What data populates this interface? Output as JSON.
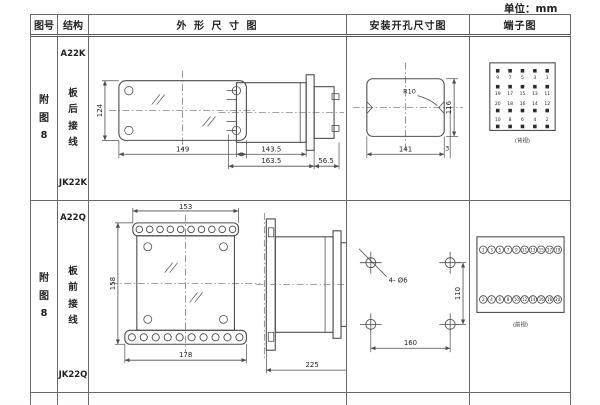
{
  "unit_label": "单位：mm",
  "headers": {
    "fig_no": "图号",
    "structure": "结构",
    "outline": "外 形 尺 寸 图",
    "mounting": "安装开孔尺寸图",
    "terminal": "端子图"
  },
  "rows": [
    {
      "fig_no": "附\n图\n8",
      "model_top": "A22K",
      "wiring": "板\n后\n接\n线",
      "model_bottom": "JK22K",
      "outline": {
        "h": "124",
        "w": "149",
        "d1": "143.5",
        "d2": "163.5",
        "d3": "56.5"
      },
      "mount": {
        "r": "R10",
        "w": "141",
        "h": "116",
        "off": "3"
      },
      "terminal": {
        "caption": "(背视)",
        "grid": [
          [
            "9",
            "7",
            "5",
            "3",
            "1"
          ],
          [
            "19",
            "17",
            "15",
            "13",
            "11"
          ],
          [
            "20",
            "18",
            "16",
            "14",
            "12"
          ],
          [
            "10",
            "8",
            "6",
            "4",
            "2"
          ]
        ]
      }
    },
    {
      "fig_no": "附\n图\n8",
      "model_top": "A22Q",
      "wiring": "板\n前\n接\n线",
      "model_bottom": "JK22Q",
      "outline": {
        "top": "153",
        "h": "158",
        "bottom": "178",
        "depth": "225"
      },
      "mount": {
        "label": "4- Ø6",
        "w": "160",
        "h": "110"
      },
      "terminal": {
        "caption": "(前视)",
        "grid": [
          [
            "1",
            "3",
            "5",
            "7",
            "9",
            "11",
            "13",
            "15",
            "17",
            "19"
          ],
          [
            "2",
            "4",
            "6",
            "8",
            "10",
            "12",
            "14",
            "16",
            "18",
            "20"
          ]
        ]
      }
    }
  ]
}
